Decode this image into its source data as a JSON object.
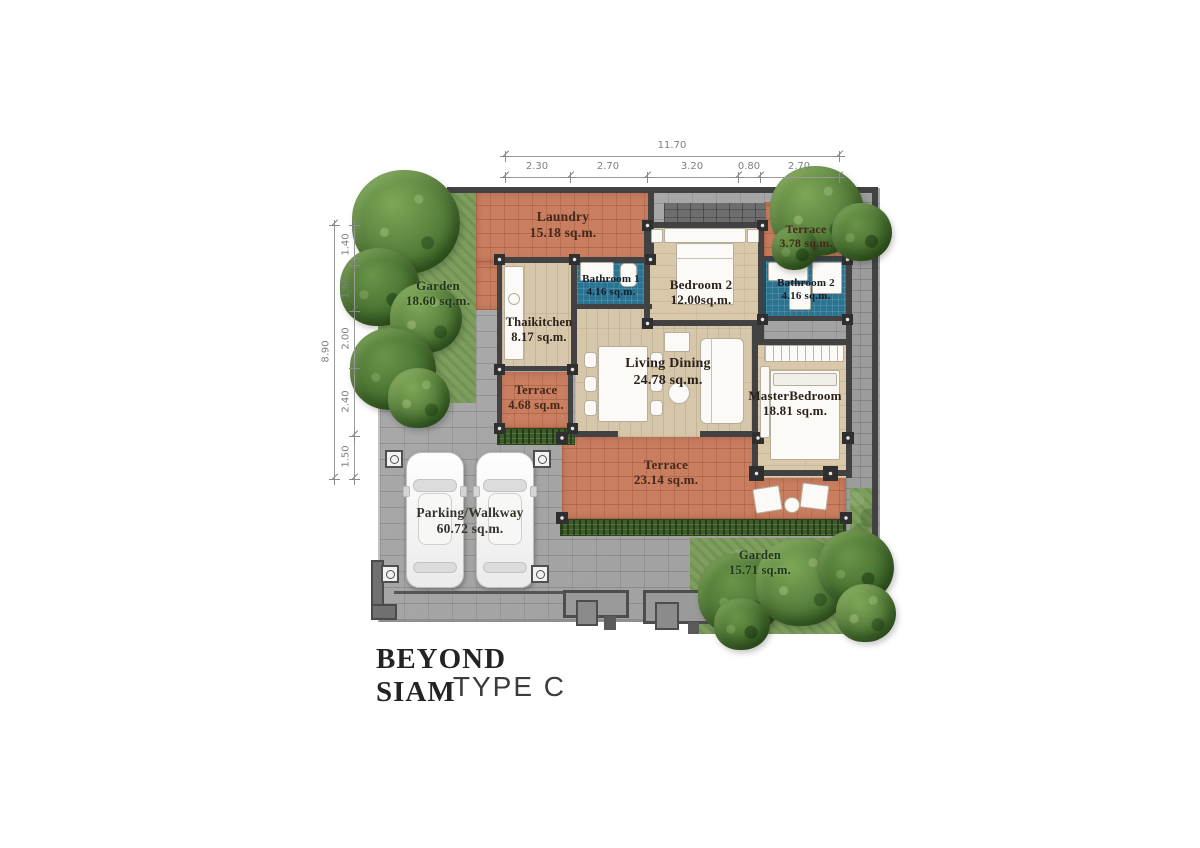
{
  "title": {
    "project": "BEYOND SIAM",
    "type": "TYPE C"
  },
  "dimensions": {
    "top": {
      "overall": "11.70",
      "segments": [
        "2.30",
        "2.70",
        "3.20",
        "0.80",
        "2.70"
      ]
    },
    "left": {
      "overall": "8.90",
      "segments": [
        "1.40",
        "1.60",
        "2.00",
        "2.40",
        "1.50"
      ]
    }
  },
  "rooms": {
    "garden_left": {
      "name": "Garden",
      "area": "18.60 sq.m."
    },
    "laundry": {
      "name": "Laundry",
      "area": "15.18 sq.m."
    },
    "terrace_top": {
      "name": "Terrace",
      "area": "3.78 sq.m."
    },
    "bathroom1": {
      "name": "Bathroom 1",
      "area": "4.16 sq.m."
    },
    "bedroom2": {
      "name": "Bedroom 2",
      "area": "12.00sq.m."
    },
    "bathroom2": {
      "name": "Bathroom 2",
      "area": "4.16 sq.m."
    },
    "thaikitchen": {
      "name": "Thaikitchen",
      "area": "8.17 sq.m."
    },
    "living_dining": {
      "name": "Living Dining",
      "area": "24.78 sq.m."
    },
    "master_bedroom": {
      "name": "MasterBedroom",
      "area": "18.81 sq.m."
    },
    "terrace_small": {
      "name": "Terrace",
      "area": "4.68 sq.m."
    },
    "terrace_main": {
      "name": "Terrace",
      "area": "23.14 sq.m."
    },
    "parking": {
      "name": "Parking/Walkway",
      "area": "60.72 sq.m."
    },
    "garden_bottom": {
      "name": "Garden",
      "area": "15.71 sq.m."
    }
  },
  "colors": {
    "terracotta": "#c87e5f",
    "paving": "#a7a7a7",
    "wood": "#d6c7ab",
    "bath_tile": "#2a7391",
    "garden": "#7d9e5c",
    "wall": "#424242"
  }
}
